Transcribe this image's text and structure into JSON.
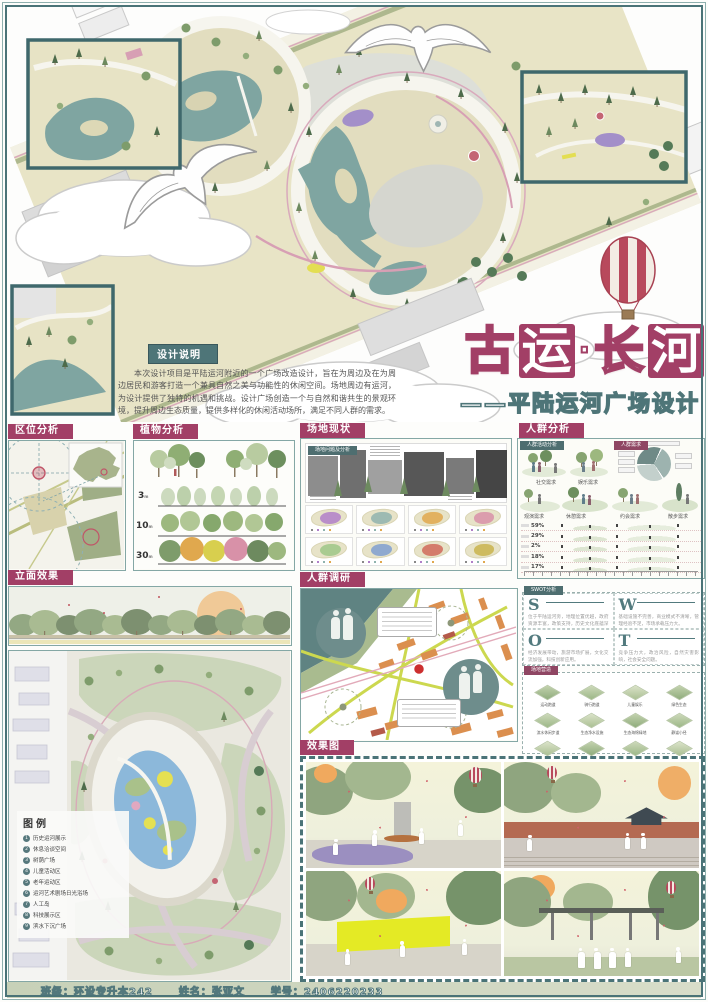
{
  "poster": {
    "title": {
      "char1": "古",
      "char2": "运",
      "char3": "·",
      "char4": "长",
      "char5": "河",
      "subtitle": "——平陆运河广场设计"
    },
    "design_note": {
      "header": "设计说明",
      "body": "本次设计项目是平陆运河附近的一个广场改造设计，旨在为周边及在为周边居民和游客打造一个兼具自然之美与功能性的休闲空间。场地周边有运河，为设计提供了独特的机遇和挑战。设计广场创造一个与自然和谐共生的景观环境，提升周边生态质量，提供多样化的休闲活动场所，满足不同人群的需求。"
    }
  },
  "sections": {
    "location": {
      "header": "区位分析"
    },
    "plants": {
      "header": "植物分析",
      "y1": "3",
      "y2": "10",
      "y3": "30",
      "unit": "m"
    },
    "site": {
      "header": "场地现状",
      "sublabel": "场地问题及分析"
    },
    "crowd": {
      "header": "人群分析",
      "tab_left": "人群活动分析",
      "tab_right": "人群需求",
      "need1": "社交需求",
      "need2": "娱乐需求",
      "need3": "观演需求",
      "need4": "休憩需求",
      "need5": "约会需求",
      "need6": "散步需求",
      "p1": "59%",
      "p2": "29%",
      "p3": "2%",
      "p4": "18%",
      "p5": "17%"
    },
    "elevation": {
      "header": "立面效果"
    },
    "survey": {
      "header": "人群调研"
    },
    "swot": {
      "tab": "SWOT分析",
      "s": {
        "letter": "S",
        "text": "位于平陆运河旁，地理位置优越，政府资源丰富，政策支持，历史文化底蕴深厚。"
      },
      "w": {
        "letter": "W",
        "text": "基础设施不完善，商业模式不清晰，管理经验不足，市场承载压力大。"
      },
      "o": {
        "letter": "O",
        "text": "经济发展带动，旅游市场扩展，文化交流加强，科技创新应用。"
      },
      "t": {
        "letter": "T",
        "text": "竞争压力大，政治风险，自然灾害影响，社会安全问题。"
      }
    },
    "strategies": {
      "tab": "场地营造",
      "labels": [
        "运动跑道",
        "骑行跑道",
        "儿童娱乐",
        "绿色生态",
        "滨水休闲步道",
        "生态净水设施",
        "生态海绵绿地",
        "静谧小径",
        "树池座椅休息区",
        "运河文化广场",
        "演艺广场",
        "垂直绿化景墙"
      ]
    },
    "renders": {
      "header": "效果图"
    },
    "legend": {
      "title": "图例",
      "nums": [
        "1",
        "2",
        "3",
        "4",
        "5",
        "6",
        "7",
        "8",
        "9"
      ],
      "items": [
        "历史运河展示",
        "休息洽谈空间",
        "树荫广场",
        "儿童活动区",
        "老年运动区",
        "运河艺术剧场日光浴场",
        "人工岛",
        "科技展示区",
        "滨水下沉广场"
      ]
    }
  },
  "footer": {
    "class_label": "班级：环设专升本242",
    "name_label": "姓名：张亚文",
    "id_label": "学号：2406220233"
  },
  "colors": {
    "accent_magenta": "#a23f66",
    "frame_teal": "#4a7377",
    "water_teal": "#7fa5a1",
    "park_beige": "#e8e4c6"
  }
}
